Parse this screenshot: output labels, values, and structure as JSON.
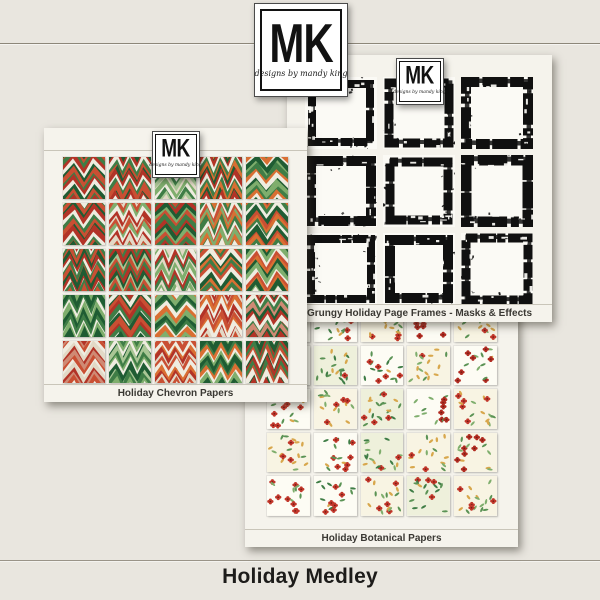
{
  "page": {
    "title": "Holiday Medley"
  },
  "colors": {
    "background": "#e9e6df",
    "sheet": "#f5f3ec",
    "title_text": "#1d1c1a",
    "divider_line": "#9a9488"
  },
  "brand": {
    "logo_text": "MK",
    "logo_subtext": "designs by mandy king"
  },
  "sheets": [
    {
      "id": "chevron",
      "label": "Holiday Chevron Papers",
      "type": "chevron",
      "grid": {
        "rows": 5,
        "cols": 5
      },
      "palettes": [
        [
          "#3f7d46",
          "#b23327",
          "#efece0",
          "#1f5c33",
          "#c94f33"
        ],
        [
          "#1f5c33",
          "#b23327",
          "#efece0",
          "#3f7d46",
          "#c94f33"
        ],
        [
          "#7fae6d",
          "#efece0",
          "#3f7d46",
          "#a9c695",
          "#e2d9c6"
        ],
        [
          "#1f5c33",
          "#b23327",
          "#efece0",
          "#3f7d46",
          "#d96f33"
        ],
        [
          "#3f7d46",
          "#d96f33",
          "#efece0",
          "#1f5c33",
          "#7fae6d"
        ],
        [
          "#b23327",
          "#efece0",
          "#3f7d46",
          "#c94f33",
          "#1f5c33"
        ],
        [
          "#e2d9c6",
          "#c94f33",
          "#7fae6d",
          "#efece0",
          "#b23327"
        ],
        [
          "#3f7d46",
          "#b23327",
          "#1f5c33",
          "#7fae6d",
          "#c94f33"
        ],
        [
          "#d96f33",
          "#3f7d46",
          "#efece0",
          "#c94f33",
          "#7fae6d"
        ],
        [
          "#c94f33",
          "#d96f33",
          "#3f7d46",
          "#efece0",
          "#1f5c33"
        ],
        [
          "#1f5c33",
          "#b23327",
          "#efece0",
          "#3f7d46",
          "#c94f33"
        ],
        [
          "#3f7d46",
          "#b23327",
          "#1f5c33",
          "#a9c695",
          "#c94f33"
        ],
        [
          "#7fae6d",
          "#efece0",
          "#b23327",
          "#3f7d46",
          "#e2d9c6"
        ],
        [
          "#3f7d46",
          "#c94f33",
          "#efece0",
          "#1f5c33",
          "#d96f33"
        ],
        [
          "#d96f33",
          "#1f5c33",
          "#7fae6d",
          "#efece0",
          "#c94f33"
        ],
        [
          "#1f5c33",
          "#3f7d46",
          "#efece0",
          "#7fae6d",
          "#1f5c33"
        ],
        [
          "#b23327",
          "#3f7d46",
          "#efece0",
          "#1f5c33",
          "#c94f33"
        ],
        [
          "#3f7d46",
          "#efece0",
          "#d96f33",
          "#7fae6d",
          "#1f5c33"
        ],
        [
          "#c94f33",
          "#d96f33",
          "#efece0",
          "#b23327",
          "#e2d9c6"
        ],
        [
          "#b23327",
          "#efece0",
          "#3f7d46",
          "#cf8a74",
          "#1f5c33"
        ],
        [
          "#cf8a74",
          "#c94f33",
          "#efece0",
          "#e2d9c6",
          "#b23327"
        ],
        [
          "#3f7d46",
          "#7fae6d",
          "#efece0",
          "#1f5c33",
          "#a9c695"
        ],
        [
          "#c94f33",
          "#efece0",
          "#d96f33",
          "#b23327",
          "#e2d9c6"
        ],
        [
          "#3f7d46",
          "#d96f33",
          "#efece0",
          "#7fae6d",
          "#1f5c33"
        ],
        [
          "#1f5c33",
          "#b23327",
          "#3f7d46",
          "#c94f33",
          "#efece0"
        ]
      ]
    },
    {
      "id": "frames",
      "label": "Grungy Holiday Page Frames - Masks & Effects",
      "type": "frame",
      "grid": {
        "rows": 3,
        "cols": 3
      },
      "frame_ink": "#101010",
      "frame_styles": [
        {
          "inset": 7,
          "t": 8
        },
        {
          "inset": 6,
          "t": 9
        },
        {
          "inset": 5,
          "t": 10
        },
        {
          "inset": 6,
          "t": 10
        },
        {
          "inset": 7,
          "t": 9
        },
        {
          "inset": 5,
          "t": 11
        },
        {
          "inset": 6,
          "t": 8
        },
        {
          "inset": 7,
          "t": 10
        },
        {
          "inset": 5,
          "t": 9
        }
      ]
    },
    {
      "id": "botanical",
      "label": "Holiday Botanical Papers",
      "type": "floral",
      "grid": {
        "rows": 5,
        "cols": 5
      },
      "palettes": [
        [
          "#fdfcf4",
          "#c2372b",
          "#5b9355",
          "#7fae6d",
          "#d8a74c",
          15,
          0
        ],
        [
          "#fdfcf4",
          "#c2372b",
          "#5b9355",
          "#3f7d46",
          "#d8a74c",
          17,
          3
        ],
        [
          "#f8f4e3",
          "#c2372b",
          "#5b9355",
          "#7fae6d",
          "#d8a74c",
          16,
          2
        ],
        [
          "#fdfcf4",
          "#b12c22",
          "#5b9355",
          "#7fae6d",
          "#d8a74c",
          15,
          0
        ],
        [
          "#f8f4e3",
          "#c2372b",
          "#7fae6d",
          "#5b9355",
          "#d8a74c",
          17,
          2
        ],
        [
          "#fdfcf4",
          "#c2372b",
          "#5b9355",
          "#7fae6d",
          "#d8a74c",
          14,
          0
        ],
        [
          "#eef0db",
          "#c2372b",
          "#3f7d46",
          "#5b9355",
          "#d8a74c",
          20,
          1
        ],
        [
          "#fdfcf4",
          "#c2372b",
          "#5b9355",
          "#3f7d46",
          "#d8a74c",
          16,
          0
        ],
        [
          "#f8f4e3",
          "#c2372b",
          "#5b9355",
          "#7fae6d",
          "#d8a74c",
          17,
          2
        ],
        [
          "#fdfcf4",
          "#b12c22",
          "#5b9355",
          "#7fae6d",
          "#d8a74c",
          15,
          3
        ],
        [
          "#fdfcf4",
          "#c2372b",
          "#5b9355",
          "#7fae6d",
          "#d8a74c",
          16,
          3
        ],
        [
          "#f8f4e3",
          "#c2372b",
          "#7fae6d",
          "#5b9355",
          "#d8a74c",
          18,
          2
        ],
        [
          "#eef0db",
          "#c2372b",
          "#3f7d46",
          "#5b9355",
          "#d8a74c",
          20,
          1
        ],
        [
          "#fdfcf4",
          "#b12c22",
          "#5b9355",
          "#7fae6d",
          "#d8a74c",
          14,
          0
        ],
        [
          "#f8f4e3",
          "#c2372b",
          "#5b9355",
          "#7fae6d",
          "#d8a74c",
          17,
          2
        ],
        [
          "#f8f4e3",
          "#c2372b",
          "#7fae6d",
          "#5b9355",
          "#d8a74c",
          18,
          2
        ],
        [
          "#fdfcf4",
          "#c2372b",
          "#5b9355",
          "#3f7d46",
          "#d8a74c",
          16,
          0
        ],
        [
          "#eef0db",
          "#c2372b",
          "#3f7d46",
          "#7fae6d",
          "#d8a74c",
          19,
          1
        ],
        [
          "#f8f4e3",
          "#c2372b",
          "#5b9355",
          "#7fae6d",
          "#d8a74c",
          16,
          2
        ],
        [
          "#f8f4e3",
          "#b12c22",
          "#5b9355",
          "#7fae6d",
          "#d8a74c",
          17,
          3
        ],
        [
          "#fdfcf4",
          "#c2372b",
          "#5b9355",
          "#7fae6d",
          "#d8a74c",
          15,
          0
        ],
        [
          "#fdfcf4",
          "#c2372b",
          "#5b9355",
          "#3f7d46",
          "#d8a74c",
          16,
          3
        ],
        [
          "#f8f4e3",
          "#c2372b",
          "#7fae6d",
          "#5b9355",
          "#d8a74c",
          17,
          2
        ],
        [
          "#eef0db",
          "#c2372b",
          "#3f7d46",
          "#5b9355",
          "#d8a74c",
          18,
          1
        ],
        [
          "#f8f4e3",
          "#c2372b",
          "#5b9355",
          "#7fae6d",
          "#d8a74c",
          17,
          3
        ]
      ]
    }
  ]
}
